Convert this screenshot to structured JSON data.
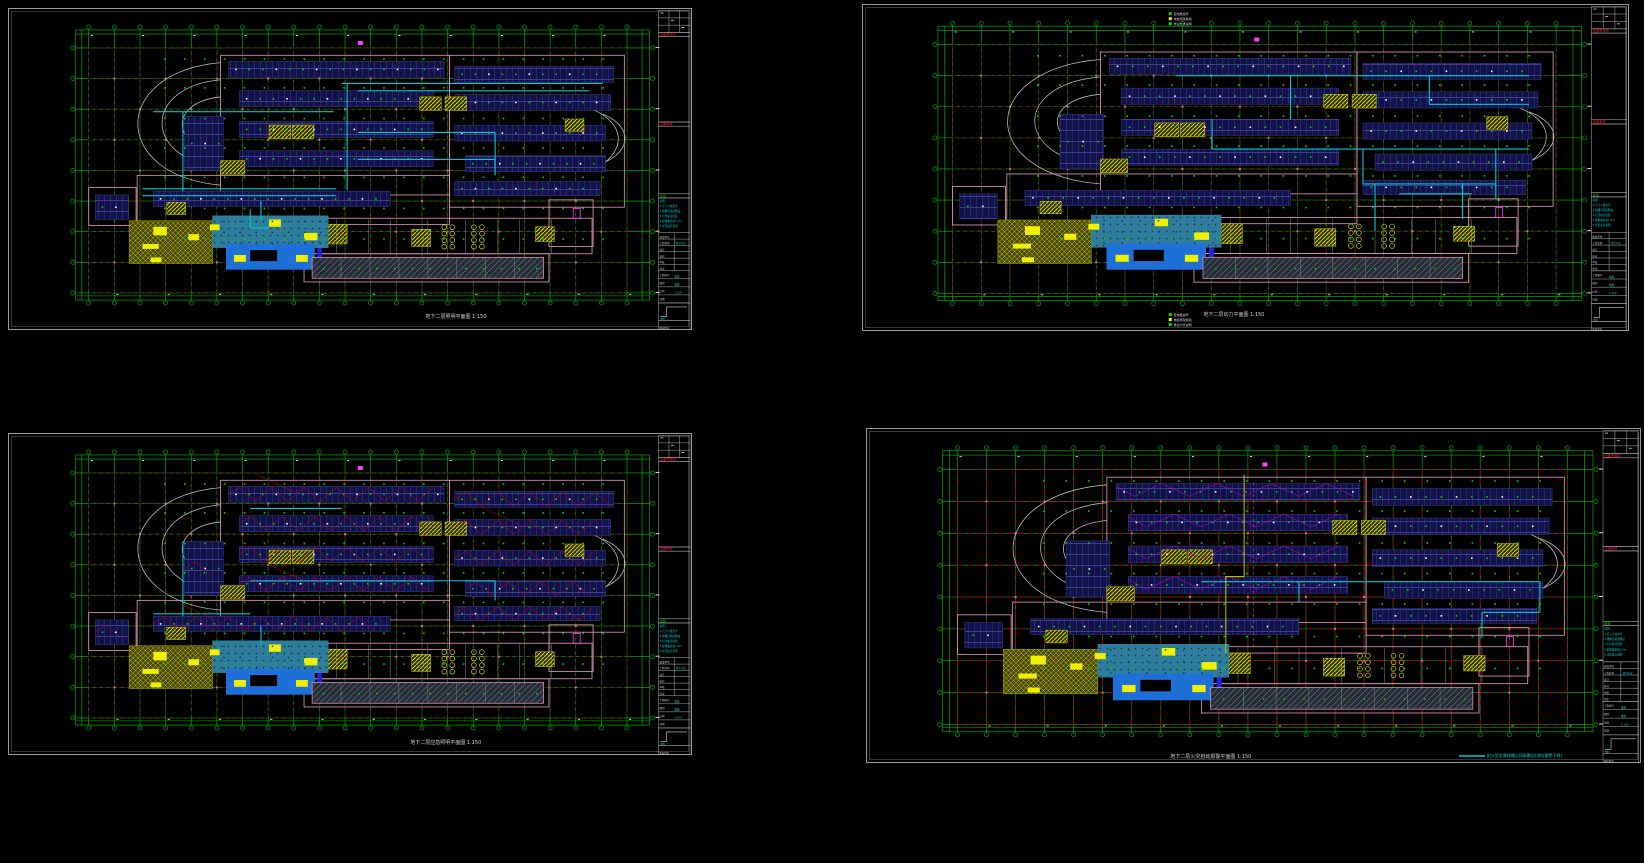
{
  "app": {
    "background": "#000000",
    "view": "CAD model space - four basement electrical floor plans"
  },
  "palette": {
    "frame_gray": "#9a9a9a",
    "inner_gray": "#5a5a5a",
    "green": "#00c300",
    "green_dot": "#00d400",
    "red_grid_dark": "#6e0000",
    "red_grid_bright": "#a80000",
    "red_wire": "#d40000",
    "cyan": "#00d8d8",
    "cyan_tray": "#00c8d8",
    "magenta": "#ff40ff",
    "pink_wall": "#e89cc0",
    "pink_col": "#c86e96",
    "stall_navy": "#12124a",
    "stall_line": "#4a4aa0",
    "yellow": "#d8d800",
    "yellow_solid": "#f0f000",
    "olive": "#4a4a00",
    "olive_line": "#c0c000",
    "teal_pool": "#2e7d9c",
    "blue_pool": "#1e6fd8",
    "dock_bg": "#262d36",
    "dock_line": "#5c6877",
    "white": "#e0e0e0",
    "ramp_gray": "#b8b8b8"
  },
  "sheets": [
    {
      "caption": "地下二层照明平面图 1:150",
      "features": {
        "red_wiring": false,
        "magenta_wiring": false,
        "yellow_feeder": false,
        "legend_top": false,
        "legend_bottom": false,
        "cyan_legend": false,
        "red_bright": false
      },
      "trays": [
        [
          [
            0.47,
            0.145
          ],
          [
            0.955,
            0.145
          ]
        ],
        [
          [
            0.5,
            0.175
          ],
          [
            0.93,
            0.175
          ]
        ],
        [
          [
            0.12,
            0.26
          ],
          [
            0.455,
            0.26
          ]
        ],
        [
          [
            0.175,
            0.26
          ],
          [
            0.175,
            0.585
          ]
        ],
        [
          [
            0.1,
            0.575
          ],
          [
            0.46,
            0.575
          ]
        ],
        [
          [
            0.1,
            0.603
          ],
          [
            0.46,
            0.603
          ]
        ],
        [
          [
            0.48,
            0.145
          ],
          [
            0.48,
            0.58
          ]
        ],
        [
          [
            0.5,
            0.345
          ],
          [
            0.755,
            0.345
          ]
        ],
        [
          [
            0.5,
            0.455
          ],
          [
            0.755,
            0.455
          ]
        ],
        [
          [
            0.755,
            0.345
          ],
          [
            0.755,
            0.52
          ]
        ],
        [
          [
            0.32,
            0.625
          ],
          [
            0.32,
            0.7
          ]
        ],
        [
          [
            0.3,
            0.66
          ],
          [
            0.3,
            0.735
          ],
          [
            0.335,
            0.735
          ]
        ]
      ]
    },
    {
      "caption": "地下二层动力平面图 1:150",
      "features": {
        "red_wiring": false,
        "magenta_wiring": false,
        "yellow_feeder": false,
        "legend_top": true,
        "legend_bottom": true,
        "cyan_legend": false,
        "red_bright": false
      },
      "trays": [
        [
          [
            0.37,
            0.125
          ],
          [
            0.955,
            0.125
          ]
        ],
        [
          [
            0.79,
            0.125
          ],
          [
            0.79,
            0.24
          ],
          [
            0.955,
            0.24
          ]
        ],
        [
          [
            0.43,
            0.42
          ],
          [
            0.955,
            0.42
          ]
        ],
        [
          [
            0.68,
            0.42
          ],
          [
            0.68,
            0.56
          ],
          [
            0.9,
            0.56
          ]
        ],
        [
          [
            0.9,
            0.42
          ],
          [
            0.9,
            0.62
          ]
        ],
        [
          [
            0.845,
            0.56
          ],
          [
            0.845,
            0.7
          ]
        ],
        [
          [
            0.56,
            0.125
          ],
          [
            0.56,
            0.3
          ]
        ],
        [
          [
            0.43,
            0.3
          ],
          [
            0.43,
            0.42
          ]
        ],
        [
          [
            0.7,
            0.56
          ],
          [
            0.7,
            0.75
          ]
        ],
        [
          [
            0.74,
            0.6
          ],
          [
            0.86,
            0.6
          ]
        ]
      ]
    },
    {
      "caption": "地下二层应急照明平面图 1:150",
      "features": {
        "red_wiring": true,
        "magenta_wiring": false,
        "yellow_feeder": false,
        "legend_top": false,
        "legend_bottom": false,
        "cyan_legend": false,
        "red_bright": false
      },
      "trays": [
        [
          [
            0.3,
            0.44
          ],
          [
            0.755,
            0.44
          ]
        ],
        [
          [
            0.755,
            0.44
          ],
          [
            0.755,
            0.52
          ]
        ],
        [
          [
            0.175,
            0.28
          ],
          [
            0.175,
            0.585
          ]
        ],
        [
          [
            0.12,
            0.575
          ],
          [
            0.3,
            0.575
          ]
        ],
        [
          [
            0.3,
            0.145
          ],
          [
            0.47,
            0.145
          ]
        ],
        [
          [
            0.32,
            0.625
          ],
          [
            0.32,
            0.7
          ]
        ]
      ]
    },
    {
      "caption": "地下二层火灾自动报警平面图 1:150",
      "features": {
        "red_wiring": false,
        "magenta_wiring": true,
        "yellow_feeder": true,
        "legend_top": false,
        "legend_bottom": false,
        "cyan_legend": true,
        "red_bright": true
      },
      "trays": [
        [
          [
            0.4,
            0.44
          ],
          [
            0.955,
            0.44
          ]
        ],
        [
          [
            0.955,
            0.44
          ],
          [
            0.955,
            0.56
          ]
        ],
        [
          [
            0.86,
            0.56
          ],
          [
            0.955,
            0.56
          ]
        ],
        [
          [
            0.56,
            0.44
          ],
          [
            0.56,
            0.52
          ]
        ],
        [
          [
            0.86,
            0.56
          ],
          [
            0.86,
            0.66
          ]
        ]
      ],
      "legend_note": "耐火型金属线槽沿顶板敷设(消防报警干线)"
    }
  ],
  "titleblock": {
    "red_stamp_top": "出图专用章",
    "red_stamp_mid": "注册师章",
    "green_mark": "会签",
    "notes_lines": [
      "说明:",
      "1.尺寸以毫米计",
      "2.线槽沿梁底敷设",
      "3.灯具吸顶安装",
      "4.配电箱底边1.5m",
      "5.详见设计说明"
    ],
    "spec_rows": [
      {
        "label": "建设单位",
        "value": ""
      },
      {
        "label": "工程名称",
        "value": "地下车库"
      },
      {
        "label": "设计",
        "value": ""
      },
      {
        "label": "校对",
        "value": ""
      },
      {
        "label": "审核",
        "value": ""
      },
      {
        "label": "审定",
        "value": ""
      }
    ],
    "stamp_rows": [
      {
        "label": "工程编号",
        "value": "电施"
      },
      {
        "label": "图别",
        "value": "电施"
      },
      {
        "label": "比例",
        "value": "1:150"
      },
      {
        "label": "日期",
        "value": ""
      }
    ],
    "diagram_label": "图标",
    "bottom_note": "版权所有"
  },
  "legend_table": {
    "rows": [
      "配电箱编号",
      "电缆桥架规格",
      "敷设方式说明"
    ]
  }
}
